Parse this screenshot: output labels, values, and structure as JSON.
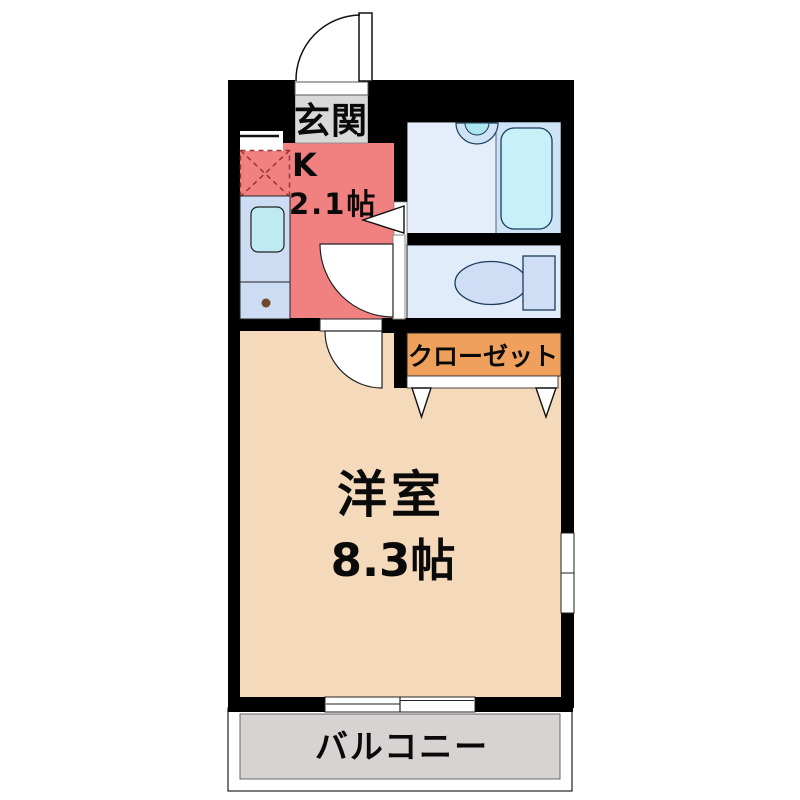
{
  "plan": {
    "genkan_label": "玄関",
    "kitchen_label": "K",
    "kitchen_size": "2.1帖",
    "closet_label": "クローゼット",
    "room_label": "洋室",
    "room_size": "8.3帖",
    "balcony_label": "バルコニー"
  },
  "colors": {
    "wall": "#000000",
    "kitchen": "#f18181",
    "room": "#f4d9bb",
    "closet": "#efa05c",
    "genkan": "#d9d9d9",
    "balcony": "#d8d3d3",
    "bath_floor": "#e4eefb",
    "bath_section": "#cfe3f7",
    "bathtub": "#c7f0f8",
    "toilet_floor": "#e0ecf9",
    "fixture": "#cfdef4",
    "counter": "#ccdcf2",
    "sink": "#bfeaf3",
    "stove_dash": "#993333",
    "gas_dot": "#6f4a28"
  }
}
